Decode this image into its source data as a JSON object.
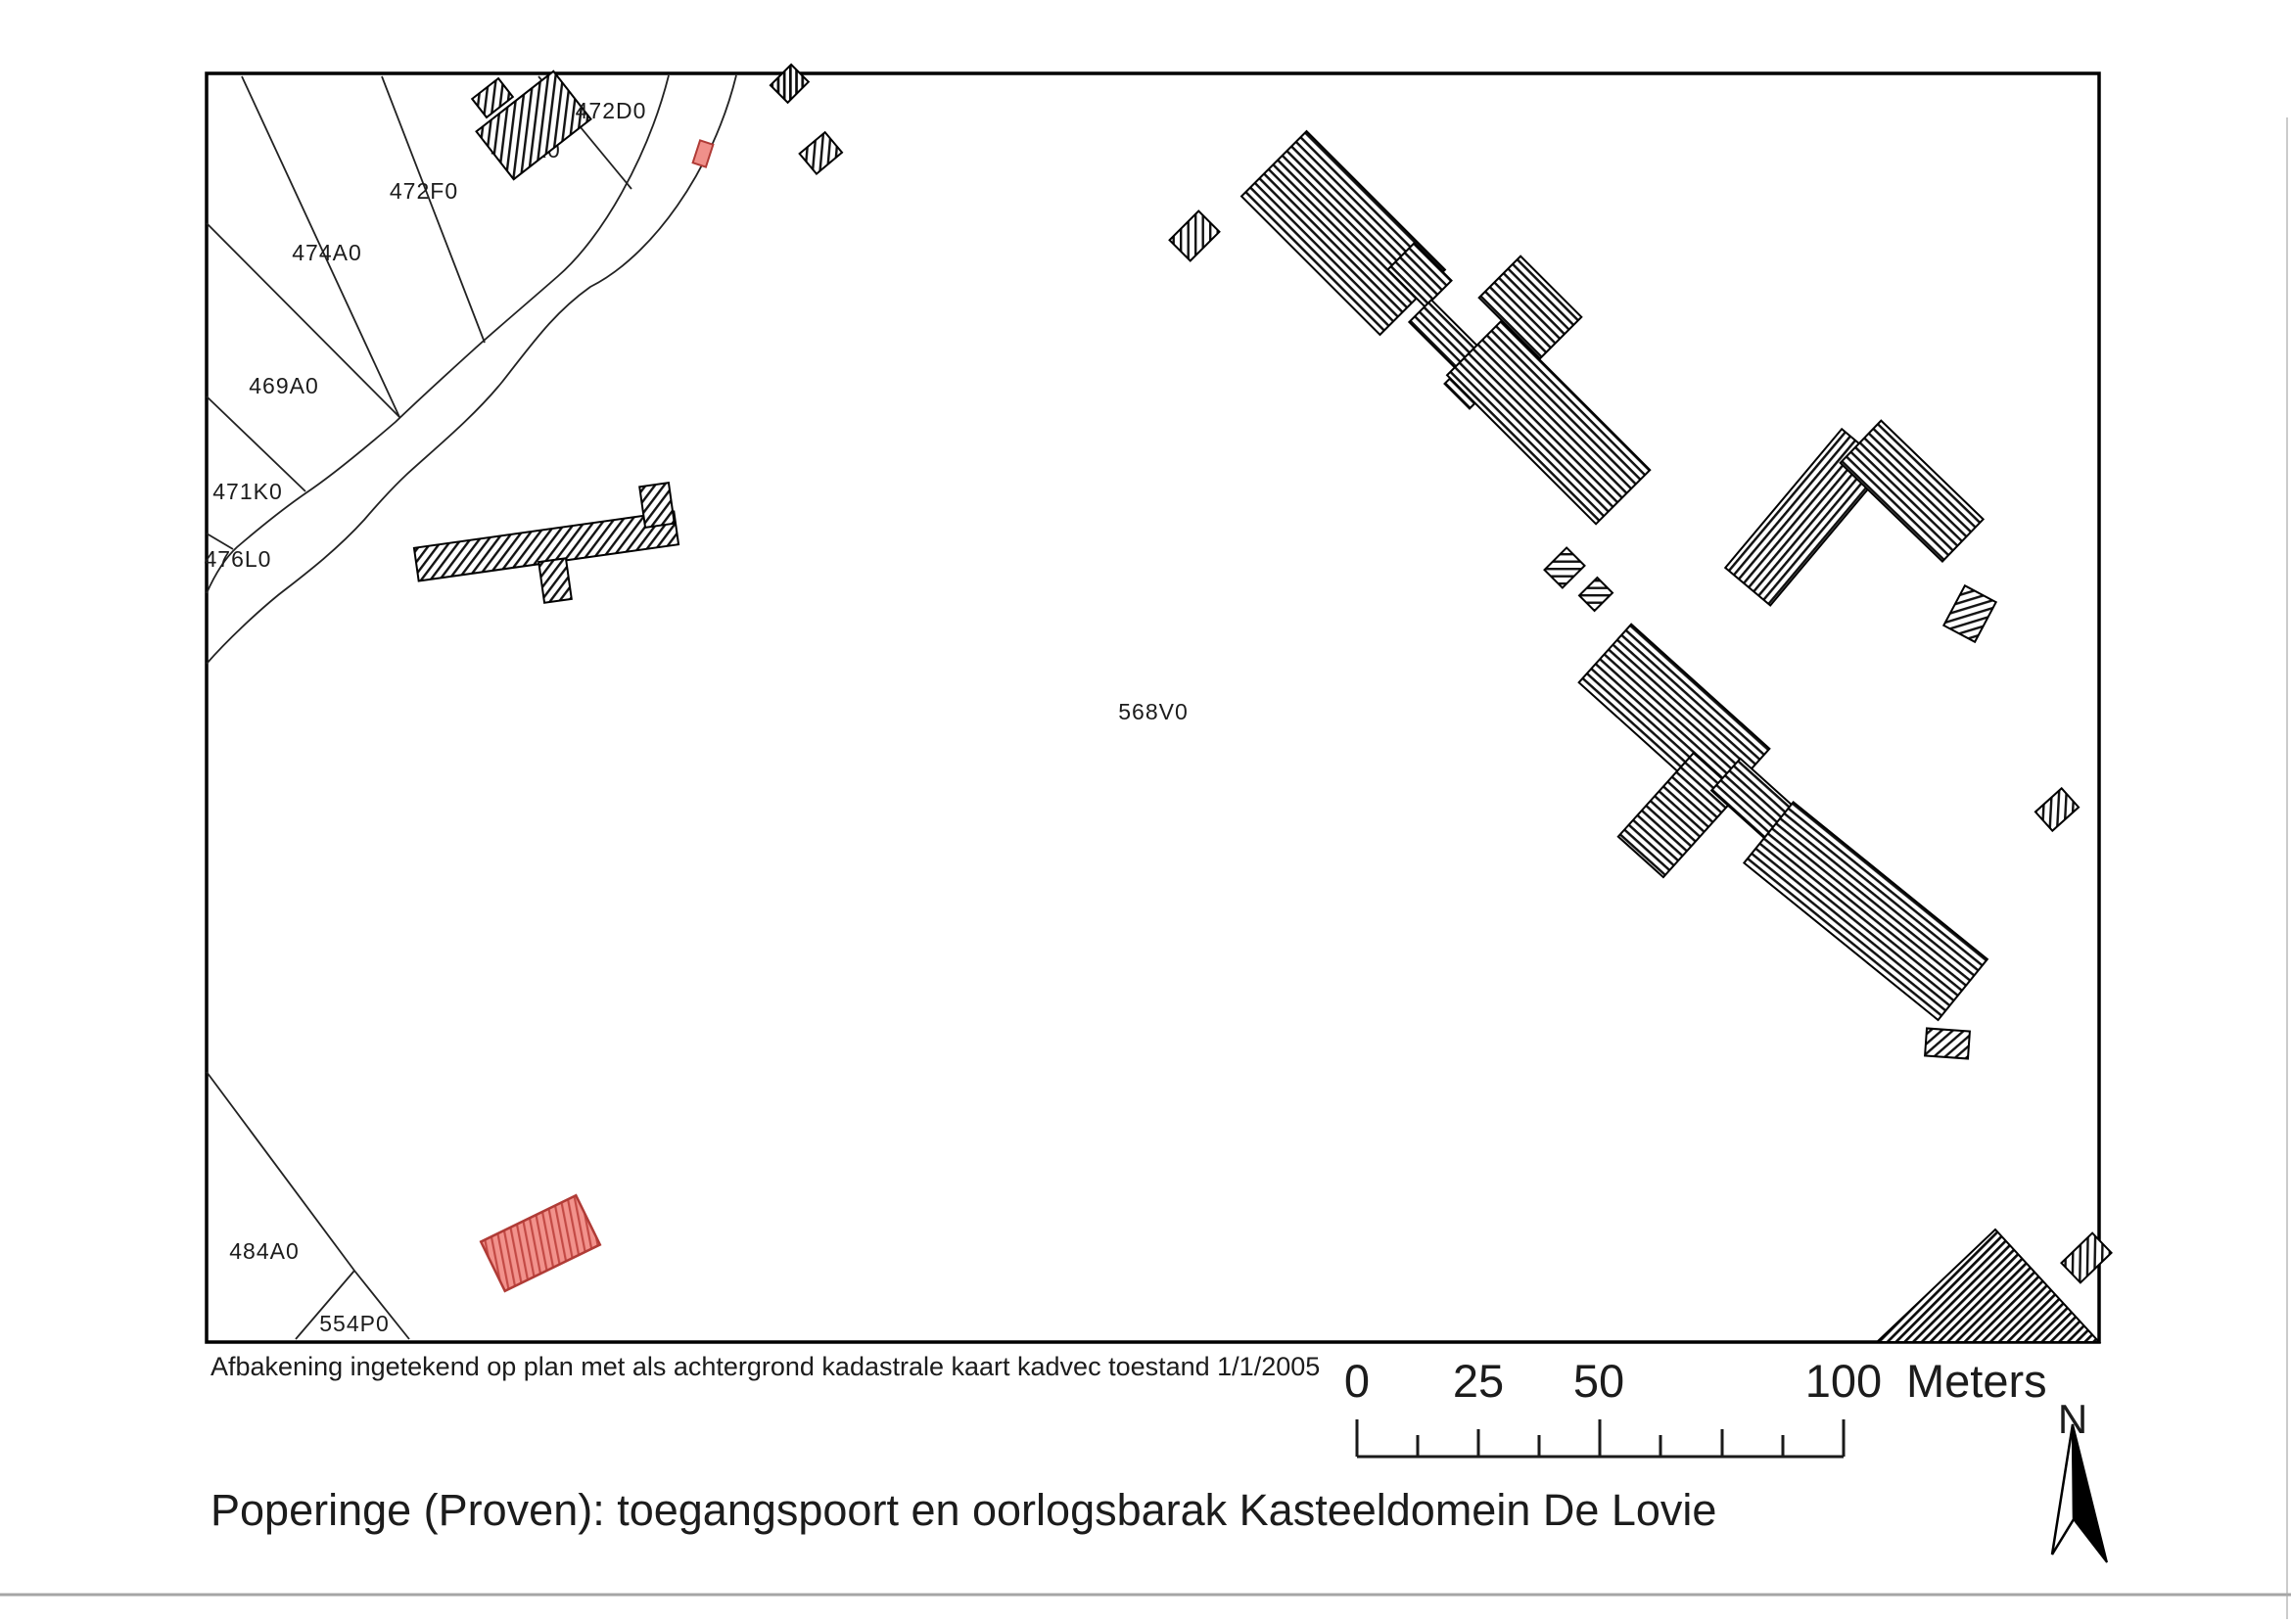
{
  "document": {
    "caption": "Afbakening ingetekend op plan met als achtergrond kadastrale kaart kadvec toestand 1/1/2005",
    "title": "Poperinge (Proven): toegangspoort en oorlogsbarak Kasteeldomein De Lovie"
  },
  "parcels": [
    "472D0",
    "472K0",
    "472F0",
    "474A0",
    "469A0",
    "471K0",
    "476L0",
    "568V0",
    "484A0",
    "554P0"
  ],
  "scalebar": {
    "t0": "0",
    "t25": "25",
    "t50": "50",
    "t100": "100",
    "unit": "Meters"
  },
  "north": {
    "label": "N"
  },
  "legend": {
    "highlight_meaning": "afbakening (delineation) highlighted building"
  },
  "colors": {
    "paper": "#ffffff",
    "ink": "#000000",
    "highlight_fill": "#f2928c",
    "highlight_stroke": "#b03b36"
  }
}
